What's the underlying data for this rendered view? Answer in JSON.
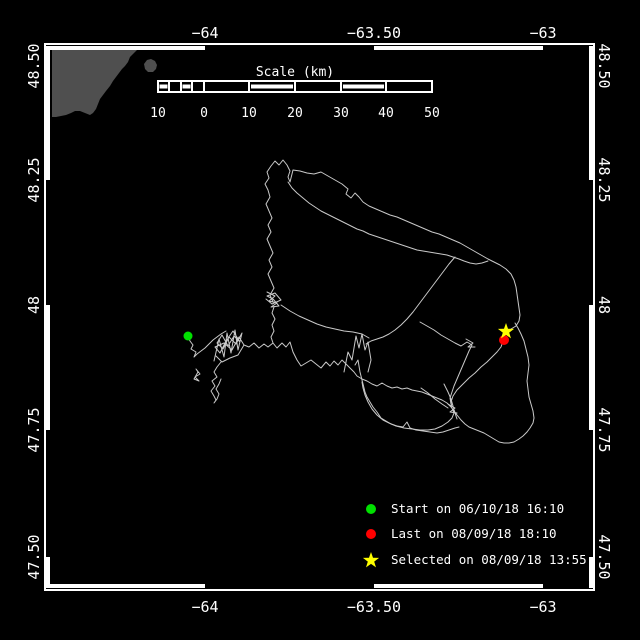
{
  "colors": {
    "background": "#000000",
    "frame": "#ffffff",
    "text": "#ffffff",
    "track": "#c9c9c9",
    "land": "#4f4f4f",
    "start_marker": "#00e000",
    "last_marker": "#ff0000",
    "selected_marker": "#ffff00"
  },
  "axis": {
    "lon_ticks": [
      {
        "label": "−64",
        "x": 205
      },
      {
        "label": "−63.50",
        "x": 374
      },
      {
        "label": "−63",
        "x": 543
      }
    ],
    "lat_ticks": [
      {
        "label": "48.50",
        "y": 66
      },
      {
        "label": "48.25",
        "y": 180
      },
      {
        "label": "48",
        "y": 305
      },
      {
        "label": "47.75",
        "y": 430
      },
      {
        "label": "47.50",
        "y": 557
      }
    ]
  },
  "scalebar": {
    "title": "Scale (km)",
    "tick_labels": [
      {
        "label": "10",
        "x": 158
      },
      {
        "label": "0",
        "x": 204
      },
      {
        "label": "10",
        "x": 249
      },
      {
        "label": "20",
        "x": 295
      },
      {
        "label": "30",
        "x": 341
      },
      {
        "label": "40",
        "x": 386
      },
      {
        "label": "50",
        "x": 432
      }
    ]
  },
  "legend": {
    "items": [
      {
        "marker": "circle",
        "color": "#00e000",
        "label": "Start on 06/10/18 16:10"
      },
      {
        "marker": "circle",
        "color": "#ff0000",
        "label": "Last on 08/09/18 18:10"
      },
      {
        "marker": "star",
        "color": "#ffff00",
        "label": "Selected on 08/09/18 13:55"
      }
    ]
  },
  "land": {
    "color": "#4f4f4f",
    "polygons": [
      "52,50 126,50 130,47 135,46 138,49 134,53 130,57 128,62 125,66 122,69 119,73 116,77 113,81 110,86 106,91 103,95 100,99 98,104 96,109 93,113 90,115 85,113 80,111 75,111 71,113 66,115 61,116 56,117 52,117",
      "144,64 147,60 151,59 155,61 157,65 156,69 153,72 148,72 145,69"
    ]
  },
  "track": {
    "color": "#c9c9c9",
    "paths": [
      "M188 336 L190 341 L193 345 L191 349 L196 352 L194 357 L197 354 L201 351 L205 348 L209 344 L213 340 L217 337 L221 334 L226 331 M214 361 L219 339 L224 357 L227 333 L231 353 L235 330 L238 350 L242 333 L236 344 L229 337 L223 349 L217 343 L222 335 L228 346 L234 336 L240 342 L233 331 L226 341 L220 353 L215 347 L224 343 L232 350 L239 337 L244 345 L238 355 L230 358 L222 362 L216 356 M221 362 L217 367 L214 372 L217 377 L212 381 L215 386 L211 391 L214 396 L216 400 L214 403 L217 399 L219 394 L216 389 L219 384 L221 379 M196 369 L200 374 L195 377 L199 381 L194 379 L198 372 L196 369",
      "M244 345 L249 347 L254 343 L259 348 L264 344 L268 347 L273 343 L277 348 L282 343 L286 347 L290 342 L293 352 L297 360 L301 366 L306 363 L311 360 L316 364 L321 368 L326 362 L330 366 L334 361 L338 365 L342 360 L346 364 L350 368 L354 372 L357 376 L362 379 L367 381 L372 384 L377 386 L382 383 L387 386 L392 388 L397 387 L402 389 L407 388 L412 390 L417 391 L422 392 L427 394 L432 396 L437 398 L442 400 L447 403 L451 407 L454 411 L457 415 L461 420 L465 424 L469 427 L474 429 L479 431 L484 433 L489 436 L494 439 L499 442 L504 443 L509 443 L514 442 L519 439 L523 436 L527 432 L530 428 L533 423 L534 418 L533 411 L531 404 L529 397 L528 389 L527 381 L528 373 L529 365 L528 357 L526 349 L524 341 L521 334 L518 328 L515 323 M344 372 L348 352 L352 360 L356 336 L359 348 L362 334 L365 350 L368 342 L371 360 L368 372",
      "M273 302 L270 295 L274 288 L271 281 L268 274 L272 267 L269 260 L273 253 L270 246 L267 239 L271 232 L268 225 L272 218 L269 211 L266 204 L270 197 L268 190 L265 184 L269 178 L267 172 L271 166 L275 161 L279 165 L283 160 L287 165 L290 171 L288 177 L290 182 M267 292 L275 296 L269 301 L277 303 L271 307 L279 306 L273 299 L267 296 L275 293 L281 300 L272 304 L266 299 M274 307 L272 313 L275 319 L272 325 L274 331 L271 337 L273 343 M290 182 L293 170 L300 171 L307 173 L314 174 L321 172 L328 176 L335 180 L342 184 L348 189 L346 194 L351 198 L355 193 L359 197 L363 202 L369 206 L376 209 L383 212 L390 215 L397 217 L404 220 L411 223 L418 226 L425 229 L432 232 L439 234 L446 237 L453 240 L460 243 L467 247 L474 251 L481 255 L488 259 L494 262 L500 265 L506 269 L511 274 L514 280 L516 287 L517 294 L518 301 L519 308 L520 315 L519 321 L516 326 L511 329 L507 332 L504 336 L503 341 L501 347 L497 352 L492 357 L487 362 L481 367 L475 373 L469 378 L463 384 L457 390 L453 396 L451 402 L452 408 L454 413 L452 418 L448 422 L442 426 L435 429 L428 430 L420 430 L412 429 L404 428 L396 426 L389 423 L383 420 L377 415 L372 409 L368 402 L365 395 L363 388 L362 382 M288 182 L292 188 L297 193 L303 198 L309 203 L315 207 L321 211 L327 214 L333 217 L339 220 L345 223 L351 226 L357 229 L363 231 L369 234 L375 236 L381 238 L387 240 L393 242 L399 244 L405 246 L411 248 L417 250 L423 251 L429 252 L435 253 L441 254 L447 255 L453 257 L459 259 L464 261 L470 263 L476 264 L482 263 L488 261",
      "M455 257 L449 264 L443 272 L437 280 L431 288 L425 296 L419 304 L413 312 L407 319 L401 325 L395 330 L389 334 L383 337 L377 339 L371 341 L366 344 M281 305 L290 311 L299 316 L308 320 L317 324 L326 327 L335 329 L344 331 L353 332 L362 334 L369 338 M420 322 L427 326 L434 330 L441 335 L448 339 L455 343 L461 346 L467 342 L472 345 L469 351 L466 358 L463 365 L460 372 L457 379 L454 386 L452 392 L450 398 L451 404 M421 388 L428 393 L435 399 L442 404 L448 408 M444 384 L448 392 L451 399 L453 406 L455 413 L457 419 M466 339 L473 343 L468 347 L475 347 M448 404 L455 408 L450 412 L457 413 M355 365 L358 360 L360 372 L362 380 L365 392 L367 397 L370 402 L373 407 L377 412 L381 418 L386 421 L391 424 L397 426 L403 427 L407 422 L410 428 L416 430 L423 431 L430 432 L437 433 L443 432 L449 430 L455 428 L459 427"
    ]
  },
  "markers": {
    "start": {
      "x": 188,
      "y": 336,
      "r": 4.5,
      "color": "#00e000"
    },
    "last": {
      "x": 504,
      "y": 340,
      "r": 5,
      "color": "#ff0000"
    },
    "selected": {
      "color": "#ffff00",
      "points": "506,323 508,328.8 514.1,328.9 509.2,332.6 511,338.4 506,334.9 501,338.4 502.8,332.6 497.9,328.9 504,328.8"
    }
  },
  "legend_markers": {
    "start": {
      "x": 371,
      "y": 509,
      "r": 5
    },
    "last": {
      "x": 371,
      "y": 534,
      "r": 5
    },
    "star_points": "371,552 373,557.8 379.1,557.9 374.2,561.6 376,567.4 371,563.9 366,567.4 367.8,561.6 362.9,557.9 369,557.8"
  }
}
